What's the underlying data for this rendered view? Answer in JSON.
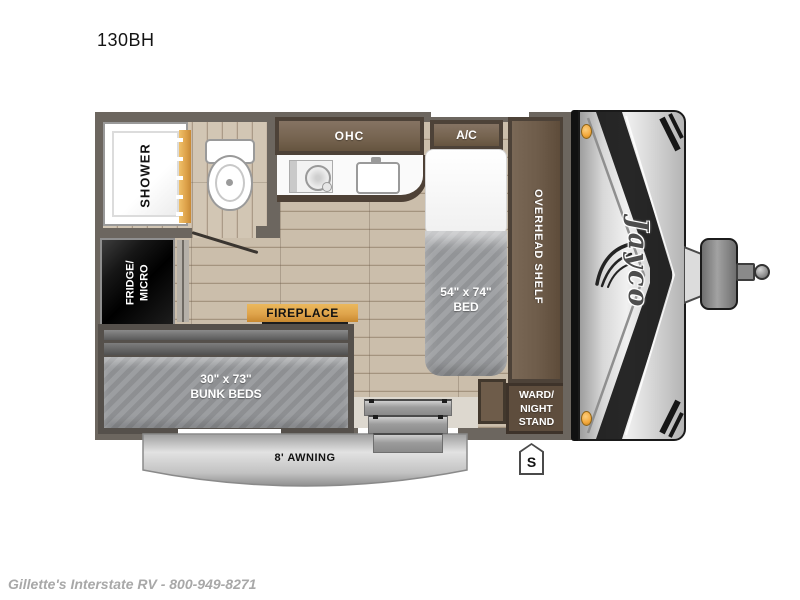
{
  "page": {
    "model": "130BH",
    "dealer_footer": "Gillette's Interstate RV - 800-949-8271"
  },
  "floorplan": {
    "brand_logo": "Jayco",
    "stabilizer_symbol": "S",
    "labels": {
      "ohc": "OHC",
      "ac": "A/C",
      "shower": "SHOWER",
      "fridge": {
        "line1": "FRIDGE/",
        "line2": "MICRO"
      },
      "fireplace": "FIREPLACE",
      "bed": {
        "line1": "54\" x 74\"",
        "line2": "BED"
      },
      "overhead_shelf": "OVERHEAD SHELF",
      "wardrobe": {
        "line1": "WARD/",
        "line2": "NIGHT",
        "line3": "STAND"
      },
      "bunks": {
        "line1": "30\" x 73\"",
        "line2": "BUNK BEDS"
      },
      "awning": "8' AWNING"
    },
    "colors": {
      "wall": "#6C665F",
      "wood_floor": "#CBBEAB",
      "cabinet_dark": "#4D4238",
      "cabinet_brown": "#75634F",
      "appliance_black": "#161616",
      "accent_gold": "#DFA44C",
      "mattress_gray": "#97999C",
      "awning_silver": "#C9C9C9",
      "marker_light_amber": "#F4A83B"
    }
  }
}
